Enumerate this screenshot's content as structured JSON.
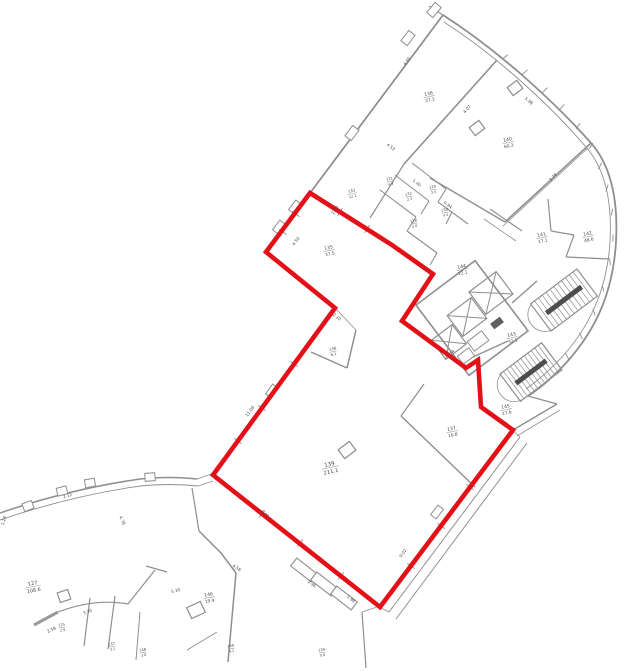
{
  "colors": {
    "background": "#ffffff",
    "walls": "#8f8f8f",
    "walls_dark": "#606060",
    "text": "#4a4a4a",
    "highlight_red": "#e31017"
  },
  "unit_outline": {
    "points": [
      [
        310,
        193
      ],
      [
        392,
        245
      ],
      [
        433,
        274
      ],
      [
        402,
        321
      ],
      [
        466,
        368
      ],
      [
        478,
        360
      ],
      [
        481,
        407
      ],
      [
        513,
        430
      ],
      [
        380,
        607
      ],
      [
        213,
        475
      ],
      [
        335,
        308
      ],
      [
        266,
        252
      ]
    ],
    "stroke_width": 4.6
  },
  "rooms": [
    {
      "n": "136",
      "a": "37.3",
      "x": 429,
      "y": 96,
      "r": -12
    },
    {
      "n": "140",
      "a": "60.3",
      "x": 508,
      "y": 142,
      "r": -12
    },
    {
      "n": "141",
      "a": "17.1",
      "x": 542,
      "y": 237,
      "r": -12
    },
    {
      "n": "142",
      "a": "48.6",
      "x": 588,
      "y": 236,
      "r": -12
    },
    {
      "n": "135",
      "a": "37.5",
      "x": 329,
      "y": 250,
      "r": -12
    },
    {
      "n": "133",
      "a": "12.1",
      "x": 352,
      "y": 193,
      "r": -12,
      "s": 3.8
    },
    {
      "n": "131",
      "a": "4.9",
      "x": 390,
      "y": 181,
      "r": -12,
      "s": 3.6
    },
    {
      "n": "132",
      "a": "2.3",
      "x": 409,
      "y": 196,
      "r": -12,
      "s": 3.6
    },
    {
      "n": "129",
      "a": "3.4",
      "x": 433,
      "y": 189,
      "r": -12,
      "s": 3.6
    },
    {
      "n": "130",
      "a": "4.4",
      "x": 445,
      "y": 212,
      "r": -12,
      "s": 3.6
    },
    {
      "n": "128",
      "a": "2.0",
      "x": 414,
      "y": 223,
      "r": -12,
      "s": 3.6
    },
    {
      "n": "144",
      "a": "22.1",
      "x": 462,
      "y": 269,
      "r": -12
    },
    {
      "n": "143",
      "a": "32.1",
      "x": 512,
      "y": 337,
      "r": -12
    },
    {
      "n": "145",
      "a": "27.6",
      "x": 506,
      "y": 409,
      "r": -12
    },
    {
      "n": "137",
      "a": "16.8",
      "x": 452,
      "y": 431,
      "r": -12
    },
    {
      "n": "138",
      "a": "6.1",
      "x": 333,
      "y": 351,
      "r": -12,
      "s": 3.8
    },
    {
      "n": "139",
      "a": "211.1",
      "x": 330,
      "y": 467,
      "r": -12,
      "s": 5.6
    },
    {
      "n": "127",
      "a": "108.6",
      "x": 33,
      "y": 586,
      "r": -10,
      "s": 5.2
    },
    {
      "n": "146",
      "a": "19.9",
      "x": 209,
      "y": 597,
      "r": -10
    },
    {
      "n": "125",
      "a": "2.9",
      "x": 62,
      "y": 627,
      "r": -10,
      "s": 3.6
    },
    {
      "n": "147",
      "a": "3.1",
      "x": 112,
      "y": 646,
      "r": -10,
      "s": 3.6
    },
    {
      "n": "148",
      "a": "3.8",
      "x": 143,
      "y": 652,
      "r": -10,
      "s": 3.6
    },
    {
      "n": "149",
      "a": "4.2",
      "x": 231,
      "y": 648,
      "r": -10,
      "s": 3.6
    },
    {
      "n": "126",
      "a": "5.6",
      "x": 322,
      "y": 652,
      "r": -10,
      "s": 3.6
    }
  ],
  "dimensions": [
    {
      "t": "4.53",
      "x": 390,
      "y": 148,
      "r": 37
    },
    {
      "t": "4.45",
      "x": 408,
      "y": 62,
      "r": -53
    },
    {
      "t": "5.98",
      "x": 528,
      "y": 102,
      "r": 40
    },
    {
      "t": "2.76",
      "x": 554,
      "y": 178,
      "r": -48
    },
    {
      "t": "4.07",
      "x": 468,
      "y": 110,
      "r": -48
    },
    {
      "t": "2.90",
      "x": 336,
      "y": 211,
      "r": -53
    },
    {
      "t": "4.50",
      "x": 297,
      "y": 242,
      "r": -53
    },
    {
      "t": "1.40",
      "x": 416,
      "y": 184,
      "r": 37
    },
    {
      "t": "0.94",
      "x": 447,
      "y": 206,
      "r": 37
    },
    {
      "t": "11.06",
      "x": 251,
      "y": 412,
      "r": -54
    },
    {
      "t": "5.40",
      "x": 264,
      "y": 515,
      "r": 38
    },
    {
      "t": "2.96",
      "x": 311,
      "y": 585,
      "r": 38
    },
    {
      "t": "1.98",
      "x": 350,
      "y": 600,
      "r": 38
    },
    {
      "t": "9.02",
      "x": 404,
      "y": 554,
      "r": -53
    },
    {
      "t": "1.74",
      "x": 452,
      "y": 355,
      "r": -52
    },
    {
      "t": "2.10",
      "x": 336,
      "y": 318,
      "r": 38
    },
    {
      "t": "1.00",
      "x": 577,
      "y": 293,
      "r": -37
    },
    {
      "t": "5.10",
      "x": 176,
      "y": 592,
      "r": -14
    },
    {
      "t": "4.58",
      "x": 236,
      "y": 569,
      "r": 33
    },
    {
      "t": "3.30",
      "x": 88,
      "y": 613,
      "r": -20
    },
    {
      "t": "2.12",
      "x": 68,
      "y": 497,
      "r": -16
    },
    {
      "t": "4.78",
      "x": 121,
      "y": 521,
      "r": 64
    },
    {
      "t": "1.24",
      "x": 5,
      "y": 521,
      "r": -75
    },
    {
      "t": "2.59",
      "x": 52,
      "y": 631,
      "r": -24
    }
  ]
}
